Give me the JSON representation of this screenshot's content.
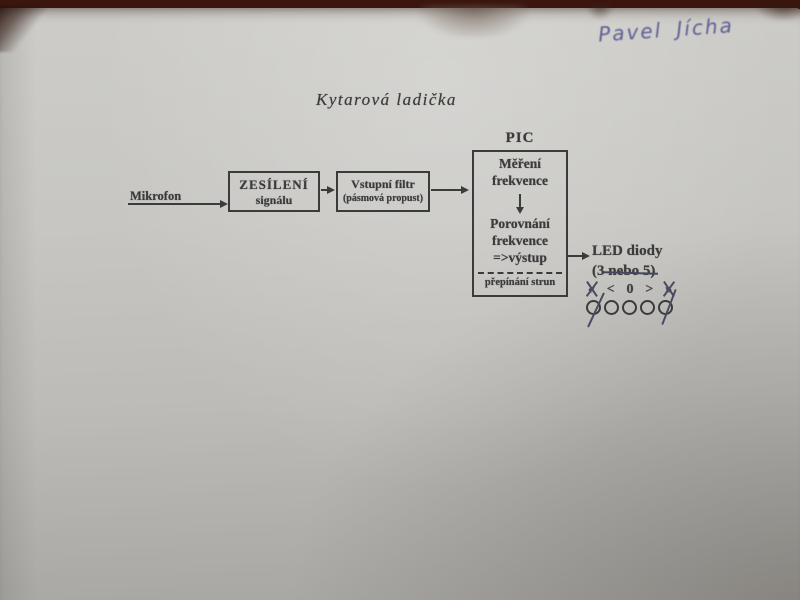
{
  "photo": {
    "handwritten_name": "Pavel Jícha"
  },
  "diagram": {
    "title": "Kytarová ladička",
    "mikrofon_label": "Mikrofon",
    "amplifier_box": {
      "line1": "ZESÍLENÍ",
      "line2": "signálu"
    },
    "filter_box": {
      "line1": "Vstupní filtr",
      "line2": "(pásmová propust)"
    },
    "pic_box": {
      "label": "PIC",
      "measure_line1": "Měření",
      "measure_line2": "frekvence",
      "compare_line1": "Porovnání",
      "compare_line2": "frekvence",
      "compare_line3": "=>výstup",
      "footer": "přepínání strun"
    },
    "led_label": {
      "line1": "LED diody",
      "line2_prefix": "(3 ",
      "line2_struck": "nebo 5)"
    },
    "indicator_symbols": [
      "«",
      "<",
      "0",
      ">",
      "»"
    ],
    "led_count": "5"
  },
  "colors": {
    "ink": "#3b3b3c",
    "pen_blue": "#5e5e94",
    "crossout_pen": "#4a4a60",
    "paper": "#c6c5c1",
    "background": "#3a160e"
  }
}
